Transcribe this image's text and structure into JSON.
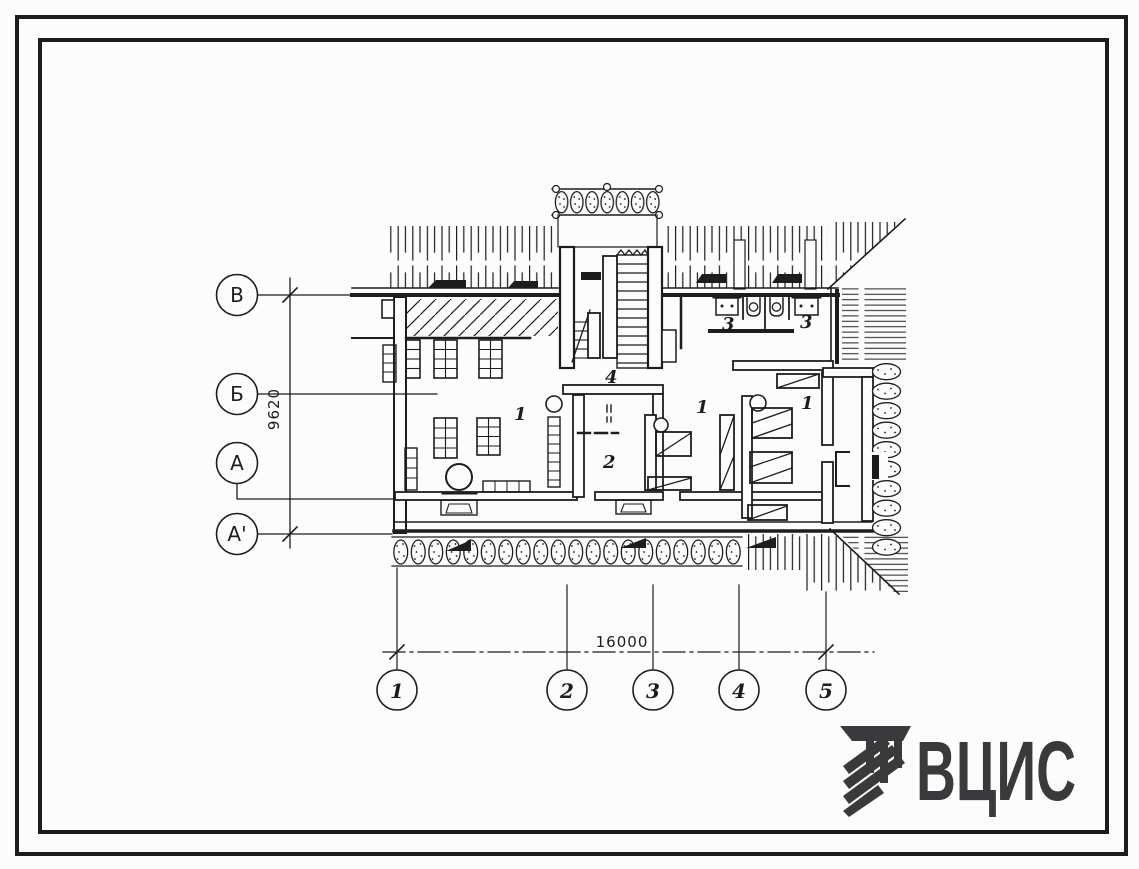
{
  "colors": {
    "ink": "#1d1d1d",
    "paper": "#fcfcfc",
    "logo_gray": "#3a3a3c"
  },
  "plan": {
    "row_axes": [
      {
        "label": "В"
      },
      {
        "label": "Б"
      },
      {
        "label": "А"
      },
      {
        "label": "А'"
      }
    ],
    "col_axes": [
      {
        "label": "1"
      },
      {
        "label": "2"
      },
      {
        "label": "3"
      },
      {
        "label": "4"
      },
      {
        "label": "5"
      }
    ],
    "dim_vertical": "9620",
    "dim_horizontal": "16000",
    "room_labels": {
      "hall_left": "1",
      "hall_center": "1",
      "hall_right": "1",
      "room_two": "2",
      "wc_left": "3",
      "wc_right": "3",
      "stairwell": "4"
    }
  },
  "logo": {
    "text": "ВЦИС"
  }
}
